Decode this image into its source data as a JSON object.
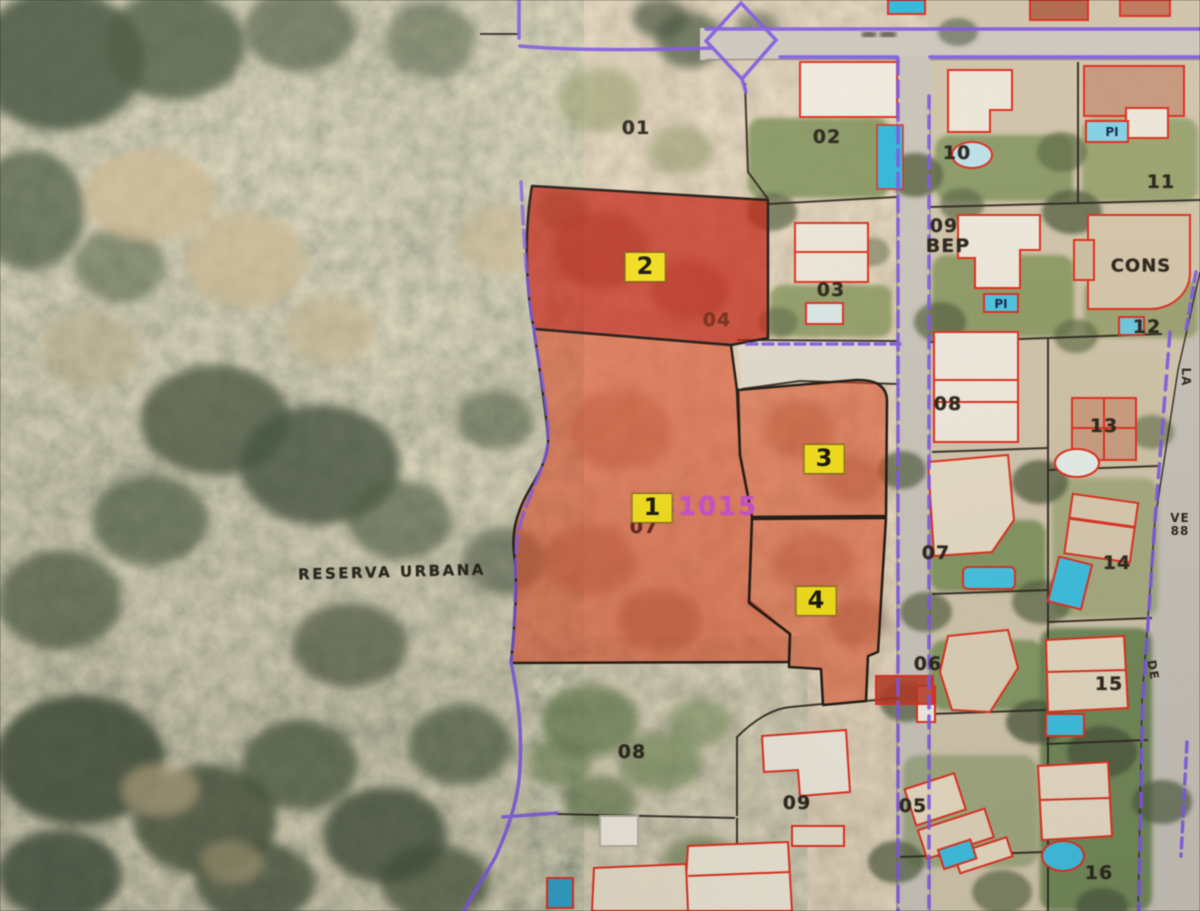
{
  "colors": {
    "marker_bg": "#f2de1d",
    "highlight_dark_red": "#bf1c0c",
    "highlight_red": "#d84420",
    "boundary_purple": "#7e57e0",
    "building_outline_red": "#dc2f1e",
    "pool_blue": "#3fbede",
    "plan_ref_color": "#c44fc6"
  },
  "map": {
    "area_name": "RESERVA URBANA",
    "plan_ref": "81015",
    "plot_markers": [
      {
        "label": "1",
        "x": 652,
        "y": 508
      },
      {
        "label": "2",
        "x": 645,
        "y": 267
      },
      {
        "label": "3",
        "x": 824,
        "y": 459
      },
      {
        "label": "4",
        "x": 816,
        "y": 601
      }
    ],
    "parcel_numbers": [
      {
        "label": "01",
        "x": 636,
        "y": 128
      },
      {
        "label": "02",
        "x": 827,
        "y": 137
      },
      {
        "label": "03",
        "x": 831,
        "y": 290
      },
      {
        "label": "04",
        "x": 717,
        "y": 320,
        "color": "#7a2a16"
      },
      {
        "label": "07",
        "x": 644,
        "y": 527,
        "color": "#5e2014"
      },
      {
        "label": "08",
        "x": 632,
        "y": 752
      },
      {
        "label": "09",
        "x": 797,
        "y": 803
      },
      {
        "label": "10",
        "x": 957,
        "y": 153
      },
      {
        "label": "09",
        "x": 944,
        "y": 226
      },
      {
        "label": "BEP",
        "x": 948,
        "y": 246
      },
      {
        "label": "11",
        "x": 1161,
        "y": 182
      },
      {
        "label": "CONS",
        "x": 1141,
        "y": 266,
        "size": 18
      },
      {
        "label": "12",
        "x": 1147,
        "y": 327
      },
      {
        "label": "08",
        "x": 948,
        "y": 404
      },
      {
        "label": "13",
        "x": 1104,
        "y": 426
      },
      {
        "label": "07",
        "x": 936,
        "y": 553
      },
      {
        "label": "14",
        "x": 1117,
        "y": 563
      },
      {
        "label": "06",
        "x": 928,
        "y": 664
      },
      {
        "label": "15",
        "x": 1109,
        "y": 684
      },
      {
        "label": "05",
        "x": 913,
        "y": 806
      },
      {
        "label": "16",
        "x": 1099,
        "y": 873
      }
    ],
    "pool_labels": [
      {
        "label": "PI",
        "x": 1112,
        "y": 132
      },
      {
        "label": "PI",
        "x": 1001,
        "y": 304
      }
    ],
    "street_labels": [
      {
        "label": "LA",
        "x": 1186,
        "y": 377,
        "rot": 90
      },
      {
        "label": "VE",
        "x": 1180,
        "y": 518
      },
      {
        "label": "88",
        "x": 1180,
        "y": 531
      },
      {
        "label": "DE",
        "x": 1153,
        "y": 670,
        "rot": 80
      }
    ]
  }
}
